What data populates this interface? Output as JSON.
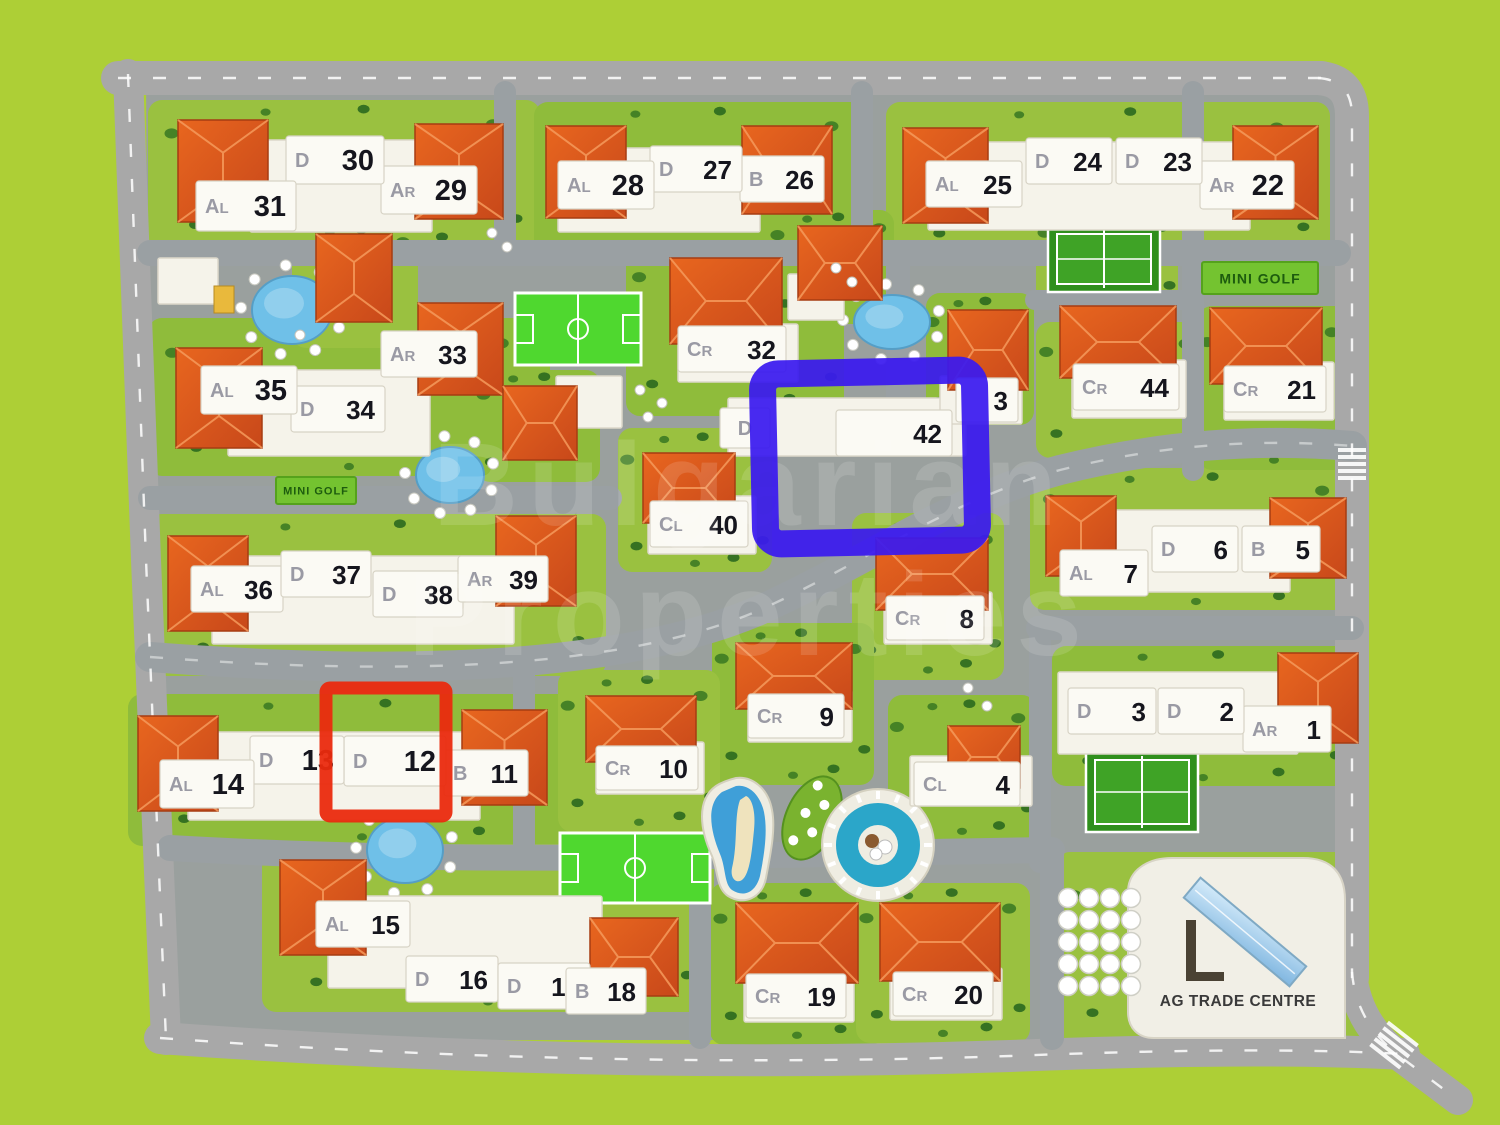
{
  "map": {
    "title": "residential complex site plan",
    "watermark": [
      "Bulgarian",
      "Properties"
    ],
    "signs": [
      {
        "label": "MINI GOLF",
        "x": 276,
        "y": 477,
        "w": 80,
        "h": 27,
        "fs": 11
      },
      {
        "label": "MINI GOLF",
        "x": 1202,
        "y": 262,
        "w": 116,
        "h": 32,
        "fs": 14
      }
    ],
    "trade_centre": {
      "label": "AG TRADE CENTRE",
      "x": 1238,
      "y": 1006
    },
    "buildings": [
      {
        "n": "1",
        "t": "AR",
        "x": 1243,
        "y": 706,
        "w": 88,
        "h": 46
      },
      {
        "n": "2",
        "t": "D",
        "x": 1158,
        "y": 688,
        "w": 86,
        "h": 46
      },
      {
        "n": "3",
        "t": "D",
        "x": 1068,
        "y": 688,
        "w": 88,
        "h": 46
      },
      {
        "n": "4",
        "t": "CL",
        "x": 914,
        "y": 762,
        "w": 106,
        "h": 44
      },
      {
        "n": "5",
        "t": "B",
        "x": 1242,
        "y": 526,
        "w": 78,
        "h": 46
      },
      {
        "n": "6",
        "t": "D",
        "x": 1152,
        "y": 526,
        "w": 86,
        "h": 46
      },
      {
        "n": "7",
        "t": "AL",
        "x": 1060,
        "y": 550,
        "w": 88,
        "h": 46
      },
      {
        "n": "8",
        "t": "CR",
        "x": 886,
        "y": 596,
        "w": 98,
        "h": 44
      },
      {
        "n": "9",
        "t": "CR",
        "x": 748,
        "y": 694,
        "w": 96,
        "h": 44
      },
      {
        "n": "10",
        "t": "CR",
        "x": 596,
        "y": 746,
        "w": 102,
        "h": 44
      },
      {
        "n": "11",
        "t": "B",
        "x": 444,
        "y": 750,
        "w": 84,
        "h": 46
      },
      {
        "n": "12",
        "t": "D",
        "x": 344,
        "y": 736,
        "w": 102,
        "h": 50
      },
      {
        "n": "13",
        "t": "D",
        "x": 250,
        "y": 736,
        "w": 94,
        "h": 48
      },
      {
        "n": "14",
        "t": "AL",
        "x": 160,
        "y": 760,
        "w": 94,
        "h": 48
      },
      {
        "n": "15",
        "t": "AL",
        "x": 316,
        "y": 901,
        "w": 94,
        "h": 46
      },
      {
        "n": "16",
        "t": "D",
        "x": 406,
        "y": 956,
        "w": 92,
        "h": 46
      },
      {
        "n": "17",
        "t": "D",
        "x": 498,
        "y": 963,
        "w": 92,
        "h": 46
      },
      {
        "n": "18",
        "t": "B",
        "x": 566,
        "y": 968,
        "w": 80,
        "h": 46
      },
      {
        "n": "19",
        "t": "CR",
        "x": 746,
        "y": 974,
        "w": 100,
        "h": 44
      },
      {
        "n": "20",
        "t": "CR",
        "x": 893,
        "y": 972,
        "w": 100,
        "h": 44
      },
      {
        "n": "21",
        "t": "CR",
        "x": 1224,
        "y": 366,
        "w": 102,
        "h": 46
      },
      {
        "n": "22",
        "t": "AR",
        "x": 1200,
        "y": 161,
        "w": 94,
        "h": 48
      },
      {
        "n": "23",
        "t": "D",
        "x": 1116,
        "y": 138,
        "w": 86,
        "h": 46
      },
      {
        "n": "24",
        "t": "D",
        "x": 1026,
        "y": 138,
        "w": 86,
        "h": 46
      },
      {
        "n": "25",
        "t": "AL",
        "x": 926,
        "y": 161,
        "w": 96,
        "h": 46
      },
      {
        "n": "26",
        "t": "B",
        "x": 740,
        "y": 156,
        "w": 84,
        "h": 46
      },
      {
        "n": "27",
        "t": "D",
        "x": 650,
        "y": 146,
        "w": 92,
        "h": 46
      },
      {
        "n": "28",
        "t": "AL",
        "x": 558,
        "y": 161,
        "w": 96,
        "h": 48
      },
      {
        "n": "29",
        "t": "AR",
        "x": 381,
        "y": 166,
        "w": 96,
        "h": 48
      },
      {
        "n": "30",
        "t": "D",
        "x": 286,
        "y": 136,
        "w": 98,
        "h": 48
      },
      {
        "n": "31",
        "t": "AL",
        "x": 196,
        "y": 181,
        "w": 100,
        "h": 50
      },
      {
        "n": "32",
        "t": "CR",
        "x": 678,
        "y": 326,
        "w": 108,
        "h": 46
      },
      {
        "n": "33",
        "t": "AR",
        "x": 381,
        "y": 331,
        "w": 96,
        "h": 46
      },
      {
        "n": "34",
        "t": "D",
        "x": 291,
        "y": 386,
        "w": 94,
        "h": 46
      },
      {
        "n": "35",
        "t": "AL",
        "x": 201,
        "y": 366,
        "w": 96,
        "h": 48
      },
      {
        "n": "36",
        "t": "AL",
        "x": 191,
        "y": 566,
        "w": 92,
        "h": 46
      },
      {
        "n": "37",
        "t": "D",
        "x": 281,
        "y": 551,
        "w": 90,
        "h": 46
      },
      {
        "n": "38",
        "t": "D",
        "x": 373,
        "y": 571,
        "w": 90,
        "h": 46
      },
      {
        "n": "39",
        "t": "AR",
        "x": 458,
        "y": 556,
        "w": 90,
        "h": 46
      },
      {
        "n": "40",
        "t": "CL",
        "x": 650,
        "y": 501,
        "w": 98,
        "h": 46
      },
      {
        "n": "42",
        "t": "",
        "x": 836,
        "y": 410,
        "w": 116,
        "h": 46
      },
      {
        "n": "3",
        "t": "",
        "x": 956,
        "y": 378,
        "w": 62,
        "h": 44
      },
      {
        "n": "44",
        "t": "CR",
        "x": 1073,
        "y": 364,
        "w": 106,
        "h": 46
      }
    ],
    "type_plates": [
      {
        "t": "D",
        "x": 720,
        "y": 408,
        "w": 50,
        "h": 40
      }
    ],
    "highlights": {
      "blue": {
        "x": 764,
        "y": 372,
        "w": 212,
        "h": 170,
        "sw": 27,
        "color": "#3a1aef",
        "target": "building-42"
      },
      "red": {
        "x": 326,
        "y": 688,
        "w": 120,
        "h": 128,
        "sw": 13,
        "color": "#ea2a0e",
        "target": "building-12"
      }
    },
    "lawns": [
      [
        148,
        100,
        392,
        152
      ],
      [
        534,
        102,
        338,
        152
      ],
      [
        886,
        102,
        444,
        160
      ],
      [
        148,
        318,
        402,
        158
      ],
      [
        148,
        514,
        458,
        162
      ],
      [
        128,
        694,
        468,
        152
      ],
      [
        262,
        844,
        452,
        168
      ],
      [
        1052,
        646,
        302,
        140
      ],
      [
        1030,
        468,
        332,
        142
      ],
      [
        626,
        238,
        218,
        178
      ],
      [
        1036,
        322,
        170,
        136
      ],
      [
        1198,
        306,
        152,
        164
      ],
      [
        852,
        513,
        152,
        167
      ],
      [
        712,
        623,
        162,
        162
      ],
      [
        558,
        670,
        162,
        162
      ],
      [
        710,
        883,
        174,
        162
      ],
      [
        856,
        883,
        174,
        160
      ],
      [
        888,
        695,
        148,
        145
      ],
      [
        618,
        428,
        154,
        144
      ],
      [
        926,
        293,
        108,
        132
      ],
      [
        292,
        222,
        126,
        126
      ],
      [
        770,
        210,
        124,
        114
      ],
      [
        1056,
        852,
        304,
        196
      ],
      [
        476,
        370,
        124,
        112
      ],
      [
        1036,
        212,
        142,
        94
      ]
    ],
    "roads": [
      {
        "d": "M118,78 H1322",
        "w": 34,
        "out": true
      },
      {
        "d": "M1318,78 Q1352,80 1352,116 V978",
        "w": 34,
        "out": true
      },
      {
        "d": "M1352,972 Q1356,1024 1402,1058 L1458,1100",
        "w": 30,
        "out": true
      },
      {
        "d": "M160,1038 Q600,1070 1010,1056 Q1260,1046 1404,1054",
        "w": 32,
        "out": true
      },
      {
        "d": "M128,74 L146,560 L166,1040",
        "w": 30,
        "out": true
      },
      {
        "d": "M150,253 H1338",
        "w": 26
      },
      {
        "d": "M505,92 V253",
        "w": 22
      },
      {
        "d": "M862,92 V253",
        "w": 22
      },
      {
        "d": "M1193,92 V253",
        "w": 22
      },
      {
        "d": "M898,255 V398",
        "w": 24
      },
      {
        "d": "M1193,255 V470",
        "w": 22
      },
      {
        "d": "M1035,300 H1193",
        "w": 20
      },
      {
        "d": "M150,498 H610",
        "w": 24
      },
      {
        "d": "M150,657 C400,676 620,670 760,610 C870,560 950,500 1060,470 C1180,440 1280,440 1352,446",
        "w": 30,
        "dash": true
      },
      {
        "d": "M1038,628 H1352",
        "w": 24
      },
      {
        "d": "M1040,628 V862",
        "w": 22
      },
      {
        "d": "M170,848 C480,866 760,854 1052,850",
        "w": 26
      },
      {
        "d": "M524,660 V848",
        "w": 22
      },
      {
        "d": "M700,856 V1038",
        "w": 22
      },
      {
        "d": "M1052,850 V1038",
        "w": 24
      }
    ],
    "slabs": [
      [
        250,
        140,
        182,
        92
      ],
      [
        558,
        148,
        202,
        84
      ],
      [
        928,
        142,
        322,
        88
      ],
      [
        228,
        370,
        202,
        86
      ],
      [
        212,
        556,
        302,
        88
      ],
      [
        188,
        732,
        292,
        88
      ],
      [
        328,
        896,
        274,
        92
      ],
      [
        1058,
        672,
        240,
        82
      ],
      [
        1088,
        510,
        202,
        82
      ],
      [
        728,
        398,
        238,
        58
      ],
      [
        648,
        496,
        108,
        58
      ],
      [
        678,
        324,
        120,
        58
      ],
      [
        1072,
        360,
        114,
        58
      ],
      [
        1224,
        362,
        110,
        58
      ],
      [
        884,
        592,
        108,
        52
      ],
      [
        748,
        690,
        104,
        52
      ],
      [
        596,
        742,
        108,
        52
      ],
      [
        744,
        970,
        110,
        52
      ],
      [
        890,
        968,
        112,
        52
      ],
      [
        910,
        756,
        122,
        50
      ],
      [
        940,
        376,
        82,
        48
      ],
      [
        788,
        274,
        56,
        46
      ],
      [
        556,
        376,
        66,
        52
      ],
      [
        158,
        258,
        60,
        46
      ]
    ],
    "roofs": [
      [
        178,
        120,
        90,
        102
      ],
      [
        415,
        124,
        88,
        95
      ],
      [
        546,
        126,
        80,
        92
      ],
      [
        742,
        126,
        90,
        88
      ],
      [
        903,
        128,
        85,
        95
      ],
      [
        1233,
        126,
        85,
        93
      ],
      [
        176,
        348,
        86,
        100
      ],
      [
        418,
        303,
        85,
        92
      ],
      [
        168,
        536,
        80,
        95
      ],
      [
        496,
        516,
        80,
        90
      ],
      [
        138,
        716,
        80,
        95
      ],
      [
        462,
        710,
        85,
        95
      ],
      [
        280,
        860,
        86,
        95
      ],
      [
        590,
        918,
        88,
        78
      ],
      [
        1278,
        653,
        80,
        90
      ],
      [
        1046,
        496,
        70,
        80
      ],
      [
        1270,
        498,
        76,
        80
      ],
      [
        670,
        258,
        112,
        86
      ],
      [
        1060,
        306,
        116,
        72
      ],
      [
        1210,
        308,
        112,
        76
      ],
      [
        948,
        310,
        80,
        80
      ],
      [
        643,
        453,
        92,
        70
      ],
      [
        876,
        538,
        112,
        72
      ],
      [
        736,
        643,
        116,
        66
      ],
      [
        586,
        696,
        110,
        66
      ],
      [
        736,
        903,
        122,
        80
      ],
      [
        880,
        903,
        120,
        78
      ],
      [
        948,
        726,
        72,
        62
      ],
      [
        316,
        234,
        76,
        88
      ],
      [
        798,
        226,
        84,
        74
      ],
      [
        503,
        386,
        74,
        74
      ]
    ],
    "courts": [
      {
        "kind": "bright",
        "x": 515,
        "y": 293,
        "w": 126,
        "h": 72,
        "name": "basketball-court"
      },
      {
        "kind": "bright",
        "x": 560,
        "y": 833,
        "w": 150,
        "h": 70,
        "name": "football-court"
      },
      {
        "kind": "tennis",
        "x": 1048,
        "y": 226,
        "w": 112,
        "h": 66,
        "name": "tennis-court-north"
      },
      {
        "kind": "tennis",
        "x": 1086,
        "y": 752,
        "w": 112,
        "h": 80,
        "name": "tennis-court-south"
      }
    ],
    "ponds": [
      {
        "cx": 292,
        "cy": 310,
        "rx": 40,
        "ry": 34
      },
      {
        "cx": 450,
        "cy": 475,
        "rx": 34,
        "ry": 28
      },
      {
        "cx": 892,
        "cy": 322,
        "rx": 38,
        "ry": 27
      },
      {
        "cx": 405,
        "cy": 850,
        "rx": 38,
        "ry": 33
      }
    ],
    "round_pool": {
      "cx": 878,
      "cy": 845,
      "r": 52
    },
    "people_dots": [
      [
        492,
        233
      ],
      [
        507,
        247
      ],
      [
        640,
        390
      ],
      [
        662,
        403
      ],
      [
        648,
        417
      ],
      [
        300,
        335
      ],
      [
        968,
        688
      ],
      [
        987,
        706
      ],
      [
        836,
        268
      ],
      [
        852,
        282
      ]
    ],
    "parking": {
      "x": 1068,
      "y": 898,
      "cols": 4,
      "rows": 5,
      "dx": 21,
      "dy": 22,
      "r": 9.5
    },
    "yellow_hut": [
      214,
      286,
      20,
      27
    ]
  },
  "colors": {
    "lime": "#adcf36",
    "base": "#9aa09e",
    "road_outer": "#a8a8a8",
    "road_inner": "#9aa0a3",
    "lawn_a": "#9ac140",
    "lawn_b": "#8fbc3b",
    "bush": "#2e6b1f",
    "bush2": "#3f7d24",
    "roof_hi": "#e8661f",
    "roof_lo": "#c8481a",
    "roof_edge": "#a63c12",
    "roof_ridge": "#f49a5c",
    "slab": "#f5f3ea",
    "slab_edge": "#dcd8ca",
    "plate": "#fbfaf4",
    "plate_edge": "#d7d3c5",
    "num": "#15151d",
    "type": "#9a9aa4",
    "court_bright": "#4fd82f",
    "tennis_dark": "#2f8f1c",
    "tennis_light": "#3fa326",
    "water": "#6fc0e8",
    "water_edge": "#559ec6",
    "pool_deep": "#2ba6c9",
    "deck": "#efede2",
    "sign_bg": "#74c330",
    "sign_edge": "#55a21c",
    "sign_text": "#1d5c0e",
    "tc_body": "#f1efe6",
    "tc_text": "#3a3a3a",
    "glass": "#a9d2ee",
    "sand": "#efe3bd",
    "leaf": "#7ab32f",
    "leaf_edge": "#55911f",
    "hut": "#e9b93c"
  }
}
